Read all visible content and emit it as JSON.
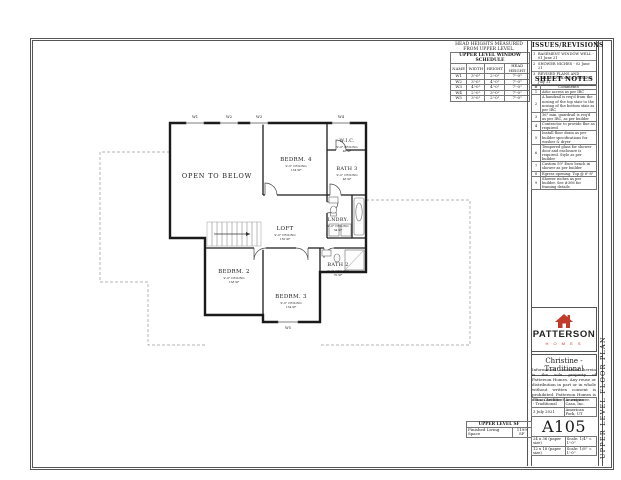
{
  "schedule_note": "HEAD HEIGHTS MEASURED FROM UPPER LEVEL.",
  "window_schedule": {
    "title": "UPPER LEVEL WINDOW SCHEDULE",
    "columns": [
      "NAME",
      "WIDTH",
      "HEIGHT",
      "HEAD HEIGHT"
    ],
    "rows": [
      {
        "name": "W1",
        "width": "3'-0\"",
        "height": "2'-0\"",
        "head_height": "7'-0\""
      },
      {
        "name": "W2",
        "width": "3'-0\"",
        "height": "4'-0\"",
        "head_height": "7'-0\""
      },
      {
        "name": "W3",
        "width": "4'-0\"",
        "height": "4'-0\"",
        "head_height": "7'-0\""
      },
      {
        "name": "W4",
        "width": "2'-0\"",
        "height": "3'-0\"",
        "head_height": "7'-0\""
      },
      {
        "name": "W5",
        "width": "3'-0\"",
        "height": "2'-0\"",
        "head_height": "7'-0\""
      }
    ]
  },
  "revisions": {
    "title": "ISSUES/REVISIONS",
    "items": [
      {
        "num": "1",
        "text": "BASEMENT WINDOW WELL - 01 June 21"
      },
      {
        "num": "2",
        "text": "SHOWER NICHES - 02 June 21"
      },
      {
        "num": "3",
        "text": "REVISED PLANS AND CHANGE ORDER ITEMS - 05 July 21"
      }
    ]
  },
  "sheet_notes": {
    "title": "SHEET NOTES",
    "number_header": "#",
    "comments_header": "Comments",
    "rows": [
      {
        "num": "1",
        "text": "Attic access as per IRC"
      },
      {
        "num": "2",
        "text": "A handrail is req'd from the nosing of the top stair to the nosing of the bottom stair as per IRC"
      },
      {
        "num": "3",
        "text": "36\" min. guardrail is req'd as per IRC, as per builder"
      },
      {
        "num": "4",
        "text": "Contractor to provide flue as required"
      },
      {
        "num": "5",
        "text": "Install floor drain as per builder specifications for washer & dryer"
      },
      {
        "num": "6",
        "text": "Tempered glass for shower door and enclosure is required. Style as per builder"
      },
      {
        "num": "7",
        "text": "Custom 59\" Euro bench in shower as per builder"
      },
      {
        "num": "8",
        "text": "Egress opening. Top @ 6'-8\""
      },
      {
        "num": "9",
        "text": "Shower niches as per builder. See #306 for framing details"
      }
    ]
  },
  "plan": {
    "open_to_below": "OPEN TO BELOW",
    "rooms": [
      {
        "name": "BEDRM. 4",
        "ceiling": "9'-0\" CEILING",
        "area": "134 SF"
      },
      {
        "name": "W.I.C.",
        "ceiling": "9'-0\" CEILING",
        "area": "46 SF"
      },
      {
        "name": "BATH 3",
        "ceiling": "9'-0\" CEILING",
        "area": "46 SF"
      },
      {
        "name": "LNDRY.",
        "ceiling": "9'-0\" CEILING",
        "area": "34 SF"
      },
      {
        "name": "LOFT",
        "ceiling": "9'-0\" CEILING",
        "area": "150 SF"
      },
      {
        "name": "BEDRM. 2",
        "ceiling": "9'-0\" CEILING",
        "area": "138 SF"
      },
      {
        "name": "BEDRM. 3",
        "ceiling": "9'-0\" CEILING",
        "area": "134 SF"
      },
      {
        "name": "BATH 2",
        "ceiling": "9'-0\" CEILING",
        "area": "70 SF"
      }
    ],
    "window_tags": [
      "W1",
      "W2",
      "W3",
      "W4",
      "W5"
    ]
  },
  "title_block": {
    "brand": "PATTERSON",
    "brand_sub": "H O M E S",
    "plan_name": "Christine - Traditional",
    "disclaimer": "Information contained herein is the sole property of Patterson Homes. Any reuse or distribution in part or in whole without written consent is prohibited. Patterson Homes is not an architect or engineer.",
    "info": {
      "plan_label": "Plan: Christine - Traditional",
      "builder": "American Casa, Inc.",
      "date": "3 July 2021",
      "location": "American Fork, UT"
    },
    "sheet_number": "A105",
    "paper_rows": [
      {
        "size": "24 x 36 (paper size)",
        "scale": "Scale: 1/4\" = 1'-0\""
      },
      {
        "size": "12 x 18 (paper size)",
        "scale": "Scale: 1/8\" = 1'-0\""
      }
    ]
  },
  "sf_table": {
    "title": "UPPER LEVEL SF",
    "label": "Finished Living Space",
    "value": "1199 SF"
  },
  "side_label": "UPPER LEVEL FLOOR PLAN"
}
